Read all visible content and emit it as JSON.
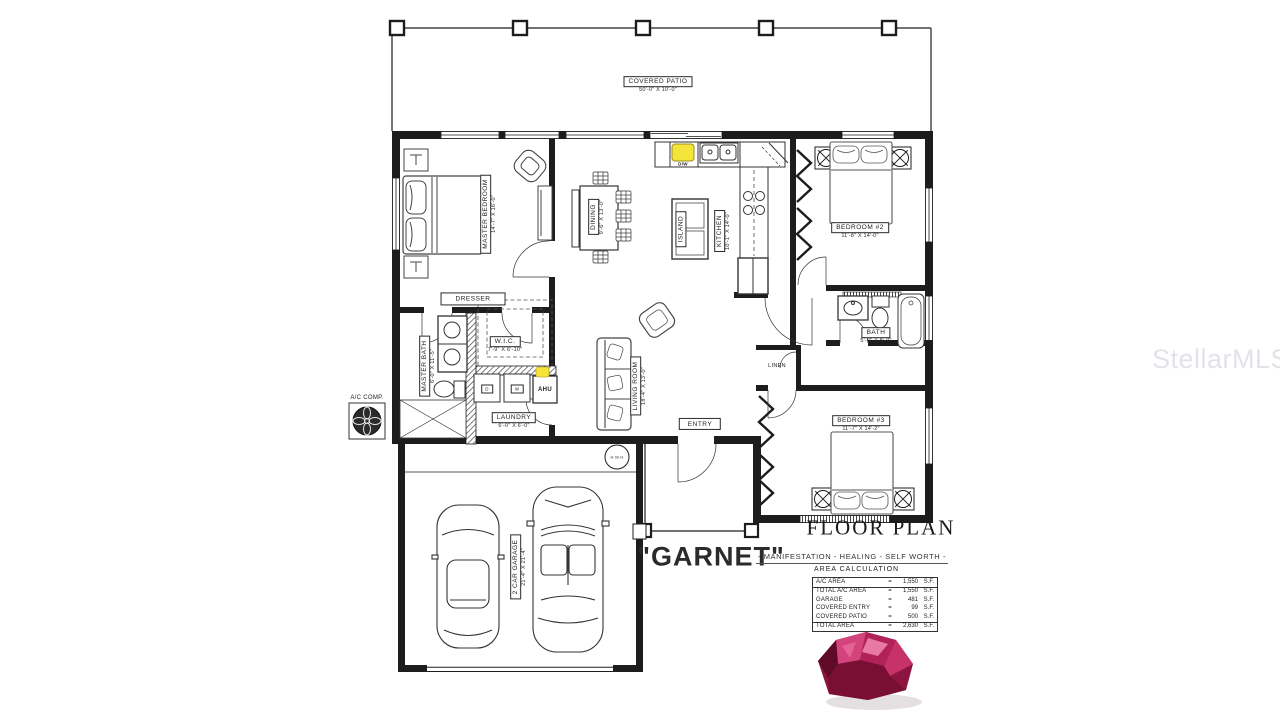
{
  "titles": {
    "floor_plan": "FLOOR PLAN",
    "plan_name": "\"GARNET\"",
    "tagline": "- MANIFESTATION - HEALING - SELF WORTH -",
    "watermark": "StellarMLS"
  },
  "rooms": {
    "covered_patio": {
      "name": "COVERED PATIO",
      "dims": "50'-0\" X 10'-0\""
    },
    "master_bedroom": {
      "name": "MASTER BEDROOM",
      "dims": "14'-7\" X 16'-0\""
    },
    "dining": {
      "name": "DINING",
      "dims": "9'-6\" X 13'-0\""
    },
    "kitchen": {
      "name": "KITCHEN",
      "dims": "10'-1\" X 14'-0\""
    },
    "island": {
      "name": "ISLAND"
    },
    "bedroom2": {
      "name": "BEDROOM #2",
      "dims": "11'-8\" X 14'-0\""
    },
    "bedroom3": {
      "name": "BEDROOM #3",
      "dims": "11'-7\" X 14'-2\""
    },
    "bath": {
      "name": "BATH",
      "dims": "5'-0\" X 8'-0\""
    },
    "master_bath": {
      "name": "MASTER BATH",
      "dims": "6'-0\" X 11'-5\""
    },
    "wic": {
      "name": "W.I.C.",
      "dims": "7'-9\" X 6'-10\""
    },
    "laundry": {
      "name": "LAUNDRY",
      "dims": "6'-0\" X 6'-0\""
    },
    "living_room": {
      "name": "LIVING ROOM",
      "dims": "18'-4\" X 13'-0\""
    },
    "garage": {
      "name": "2 CAR GARAGE",
      "dims": "21'-4\" X 21'-4\""
    },
    "entry": {
      "name": "ENTRY"
    },
    "linen": {
      "name": "LINEN"
    },
    "dresser": {
      "name": "DRESSER"
    }
  },
  "equipment": {
    "ac_comp": "A/C COMP.",
    "hwh": "H.W.H",
    "dw": "D/W",
    "dryer": "D",
    "washer": "W",
    "ahu": "AHU"
  },
  "area_calculation": {
    "title": "AREA CALCULATION",
    "rows": [
      {
        "label": "A/C AREA",
        "eq": "=",
        "value": "1,550",
        "unit": "S.F."
      },
      {
        "label": "TOTAL A/C AREA",
        "eq": "=",
        "value": "1,550",
        "unit": "S.F."
      },
      {
        "label": "GARAGE",
        "eq": "=",
        "value": "481",
        "unit": "S.F."
      },
      {
        "label": "COVERED ENTRY",
        "eq": "=",
        "value": "99",
        "unit": "S.F."
      },
      {
        "label": "COVERED PATIO",
        "eq": "=",
        "value": "500",
        "unit": "S.F."
      },
      {
        "label": "TOTAL AREA",
        "eq": "=",
        "value": "2,630",
        "unit": "S.F."
      }
    ]
  },
  "colors": {
    "wall": "#1d1d1d",
    "highlight_yellow": "#f5e53a",
    "watermark_gray": "#e2e2e9",
    "gem_dark": "#5f0a28",
    "gem_mid": "#8e1440",
    "gem_light": "#d4447c"
  }
}
